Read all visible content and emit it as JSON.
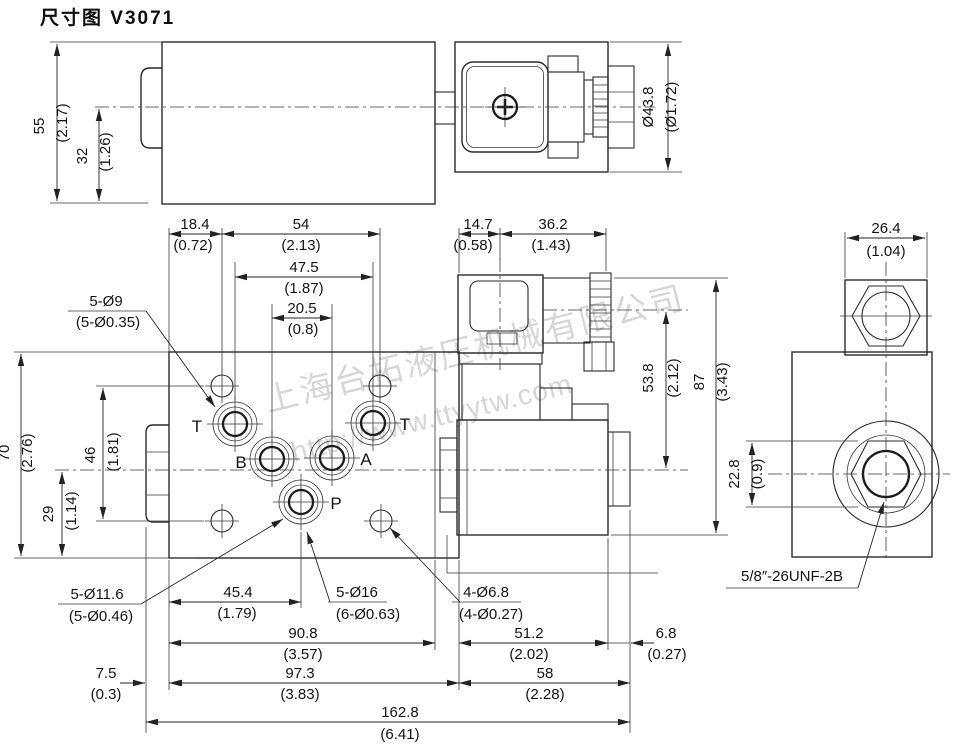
{
  "title": "尺寸图 V3071",
  "watermark": {
    "company": "上海台拓液压机械有限公司",
    "url": "http://www.ttyytw.com"
  },
  "ports": {
    "t_left": "T",
    "b": "B",
    "a": "A",
    "t_right": "T",
    "p": "P"
  },
  "thread_label": "5/8″-26UNF-2B",
  "dims": {
    "d55": {
      "mm": "55",
      "inch": "(2.17)"
    },
    "d32": {
      "mm": "32",
      "inch": "(1.26)"
    },
    "d43_8": {
      "mm": "Ø43.8",
      "inch": "(Ø1.72)"
    },
    "d18_4": {
      "mm": "18.4",
      "inch": "(0.72)"
    },
    "d54": {
      "mm": "54",
      "inch": "(2.13)"
    },
    "d47_5": {
      "mm": "47.5",
      "inch": "(1.87)"
    },
    "d20_5": {
      "mm": "20.5",
      "inch": "(0.8)"
    },
    "d14_7": {
      "mm": "14.7",
      "inch": "(0.58)"
    },
    "d36_2": {
      "mm": "36.2",
      "inch": "(1.43)"
    },
    "d26_4": {
      "mm": "26.4",
      "inch": "(1.04)"
    },
    "d70": {
      "mm": "70",
      "inch": "(2.76)"
    },
    "d46": {
      "mm": "46",
      "inch": "(1.81)"
    },
    "d29": {
      "mm": "29",
      "inch": "(1.14)"
    },
    "d53_8": {
      "mm": "53.8",
      "inch": "(2.12)"
    },
    "d87": {
      "mm": "87",
      "inch": "(3.43)"
    },
    "d22_8": {
      "mm": "22.8",
      "inch": "(0.9)"
    },
    "d45_4": {
      "mm": "45.4",
      "inch": "(1.79)"
    },
    "d90_8": {
      "mm": "90.8",
      "inch": "(3.57)"
    },
    "d51_2": {
      "mm": "51.2",
      "inch": "(2.02)"
    },
    "d6_8": {
      "mm": "6.8",
      "inch": "(0.27)"
    },
    "d7_5": {
      "mm": "7.5",
      "inch": "(0.3)"
    },
    "d97_3": {
      "mm": "97.3",
      "inch": "(3.83)"
    },
    "d58": {
      "mm": "58",
      "inch": "(2.28)"
    },
    "d162_8": {
      "mm": "162.8",
      "inch": "(6.41)"
    },
    "h9": {
      "label": "5-Ø9",
      "inch": "(5-Ø0.35)"
    },
    "h11_6": {
      "label": "5-Ø11.6",
      "inch": "(5-Ø0.46)"
    },
    "h16": {
      "label": "5-Ø16",
      "inch": "(6-Ø0.63)"
    },
    "h6_8": {
      "label": "4-Ø6.8",
      "inch": "(4-Ø0.27)"
    }
  }
}
